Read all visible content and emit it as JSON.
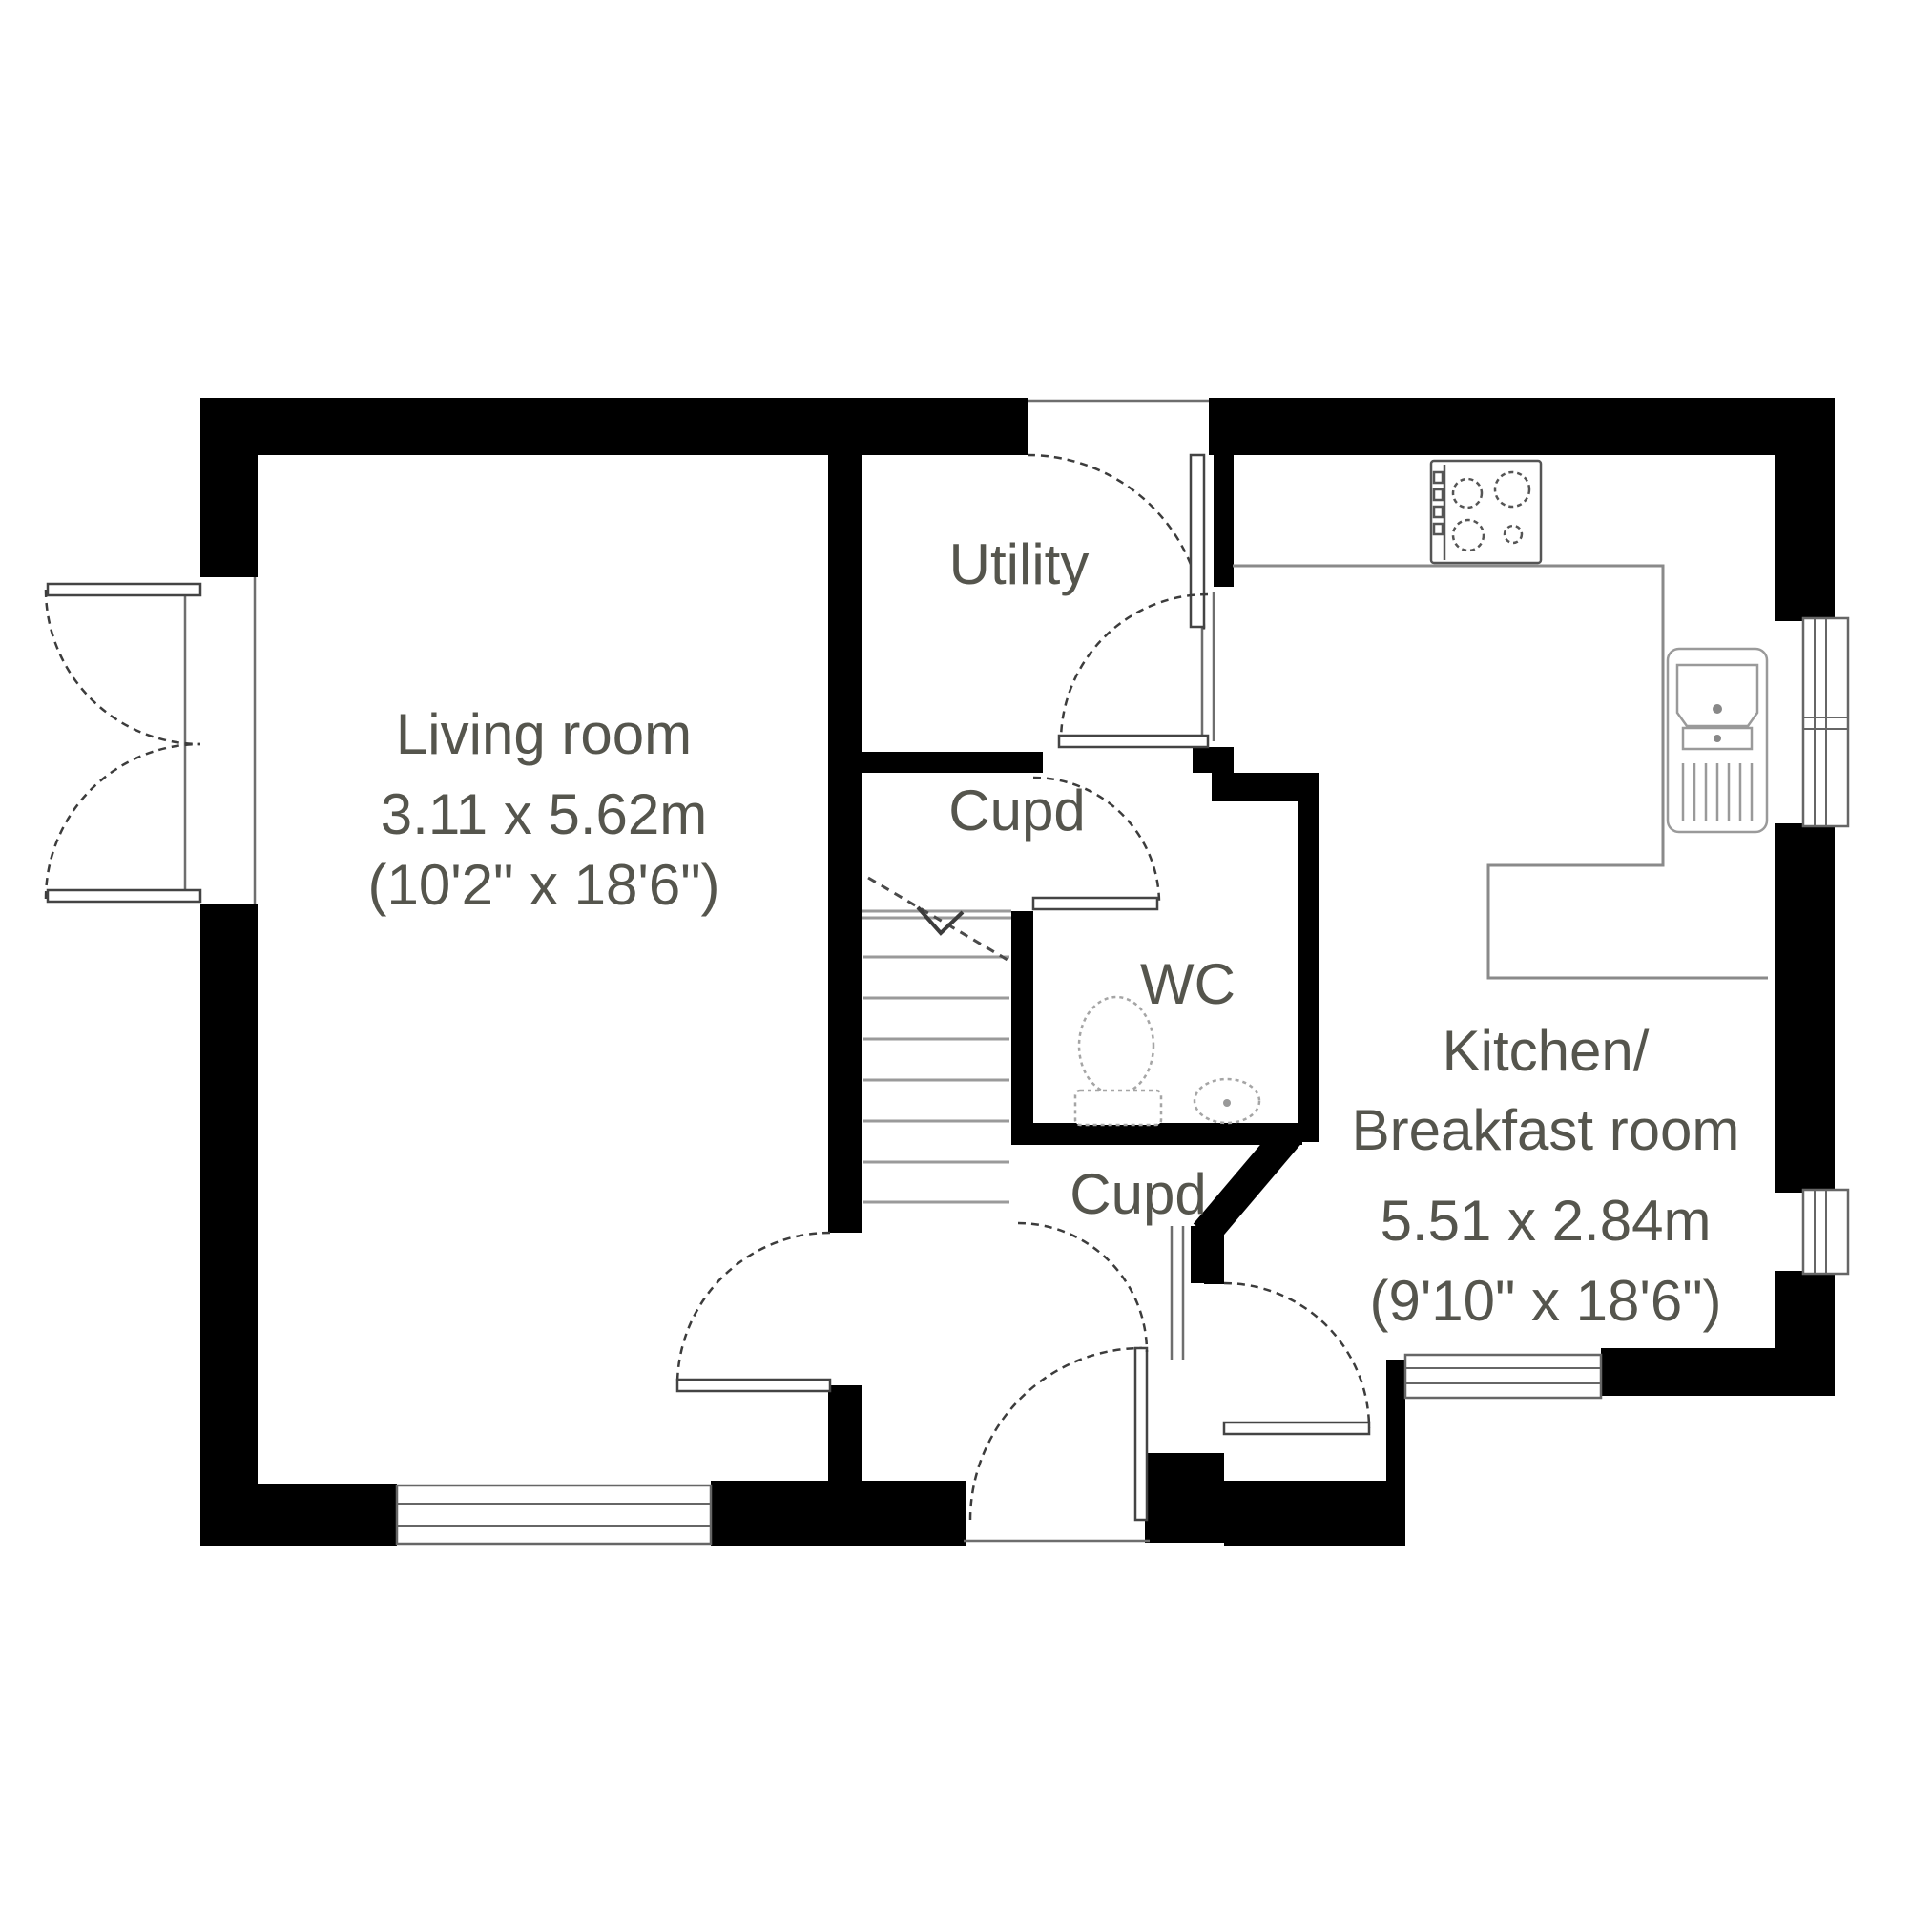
{
  "plan": {
    "background": "#ffffff",
    "colors": {
      "wall": "#000000",
      "label_text": "#55554d",
      "door_arc": "#3c3c3c",
      "counter_line": "#8a8a8a",
      "fixture_line": "#9a9a9a",
      "window_line": "#666666"
    },
    "rooms": {
      "living_room": {
        "name": "Living room",
        "dim_metric": "3.11 x 5.62m",
        "dim_imperial": "(10'2\" x 18'6\")"
      },
      "kitchen": {
        "name_line1": "Kitchen/",
        "name_line2": "Breakfast room",
        "dim_metric": "5.51 x 2.84m",
        "dim_imperial": "(9'10\" x 18'6\")"
      },
      "utility": {
        "name": "Utility"
      },
      "wc": {
        "name": "WC"
      },
      "cupboard_top": {
        "name": "Cupd"
      },
      "cupboard_bottom": {
        "name": "Cupd"
      }
    },
    "fixtures": [
      "hob",
      "sink-drainer",
      "toilet",
      "basin",
      "staircase"
    ]
  }
}
